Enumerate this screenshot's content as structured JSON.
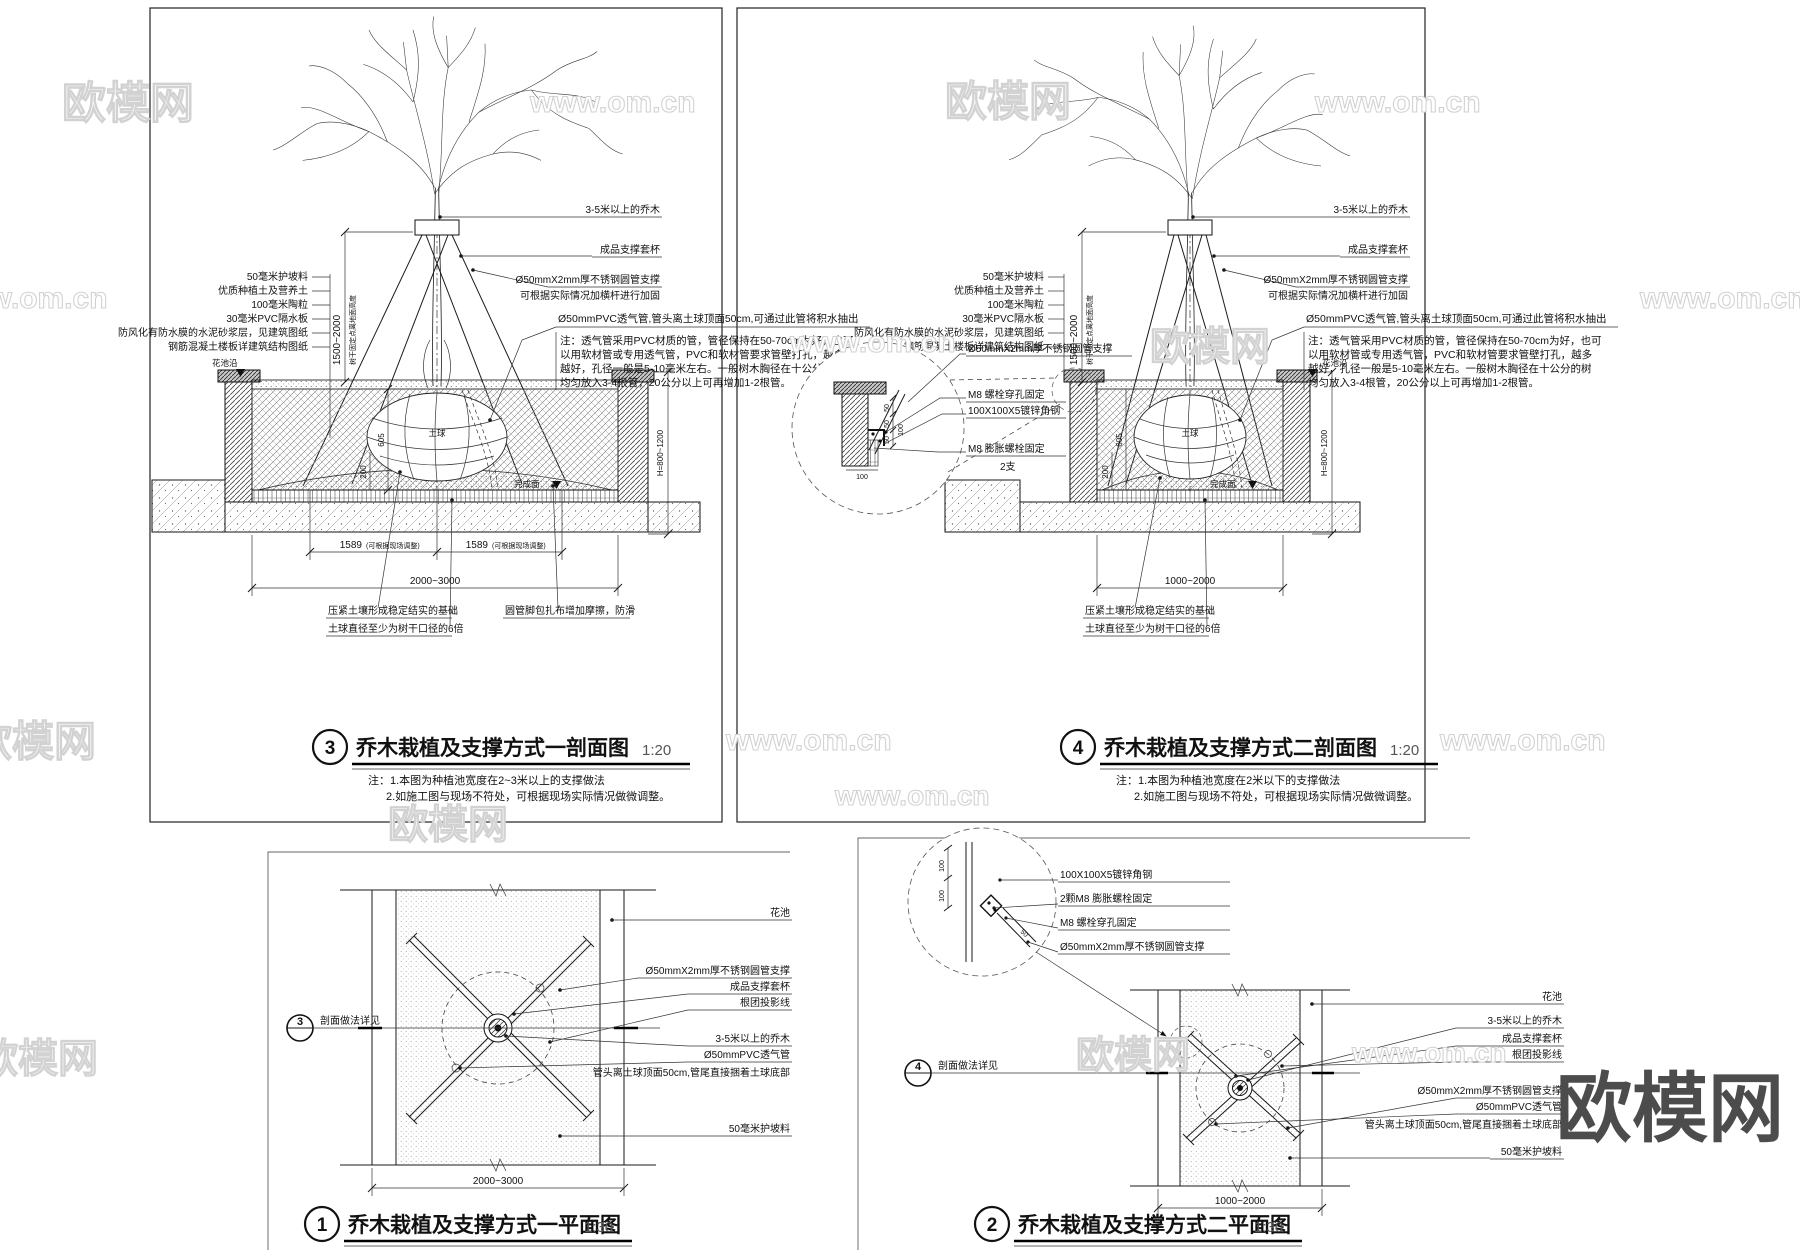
{
  "brand": {
    "logo": "欧模网",
    "url": "www.om.cn"
  },
  "shared": {
    "left_stack": [
      "50毫米护坡料",
      "优质种植土及营养土",
      "100毫米陶粒",
      "30毫米PVC隔水板",
      "防风化有防水膜的水泥砂浆层，见建筑图纸",
      "钢筋混凝土楼板详建筑结构图纸"
    ],
    "tree": "3-5米以上的乔木",
    "collar": "成品支撑套杯",
    "support": "Ø50mmX2mm厚不锈钢圆管支撑",
    "support_note": "可根据实际情况加横杆进行加固",
    "vent_title": "Ø50mmPVC透气管,管头离土球顶面50cm,可通过此管将积水抽出",
    "vent_note_1": "注：透气管采用PVC材质的管，管径保持在50-70cm为好，也可",
    "vent_note_2": "以用软材管或专用透气管，PVC和软材管要求管壁打孔，越多",
    "vent_note_3": "越好，孔径一般是5-10毫米左右。一般树木胸径在十公分的树",
    "vent_note_4": "均匀放入3-4根管，20公分以上可再增加1-2根管。",
    "planter_edge": "花池沿",
    "finish_face": "完成面",
    "root_ball": "土球",
    "foundation": "压紧土壤形成稳定结实的基础",
    "ball_dia": "土球直径至少为树干口径的6倍",
    "pipe_foot": "圆管脚包扎布增加摩擦，防滑",
    "trunk_note": "树干固定点离地面高度"
  },
  "dims": {
    "half": "1589",
    "half_note": "(可根据现场调整)",
    "w1": "2000~3000",
    "w2": "1000~2000",
    "h": "1500~2000",
    "depth": "H=800~1200",
    "ball": "605",
    "mound": "200",
    "d50": "50",
    "d100": "100"
  },
  "detail": {
    "bolt": "M8 螺栓穿孔固定",
    "angle": "100X100X5镀锌角钢",
    "anchor": "M8 膨胀螺栓固定",
    "anchor_qty": "2支",
    "anchor2": "2颗M8 膨胀螺栓固定"
  },
  "plan": {
    "planter": "花池",
    "proj": "根团投影线",
    "vent": "Ø50mmPVC透气管",
    "vent_sub": "管头离土球顶面50cm,管尾直接捆着土球底部",
    "ref": "剖面做法详见"
  },
  "views": {
    "s1": {
      "num": "3",
      "title": "乔木栽植及支撑方式一剖面图",
      "scale": "1:20",
      "note1": "注：1.本图为种植池宽度在2~3米以上的支撑做法",
      "note2": "2.如施工图与现场不符处，可根据现场实际情况做微调整。"
    },
    "s2": {
      "num": "4",
      "title": "乔木栽植及支撑方式二剖面图",
      "scale": "1:20",
      "note1": "注：1.本图为种植池宽度在2米以下的支撑做法",
      "note2": "2.如施工图与现场不符处，可根据现场实际情况做微调整。"
    },
    "p1": {
      "num": "1",
      "title": "乔木栽植及支撑方式一平面图",
      "scale": "1:30"
    },
    "p2": {
      "num": "2",
      "title": "乔木栽植及支撑方式二平面图",
      "scale": "1:30"
    }
  }
}
